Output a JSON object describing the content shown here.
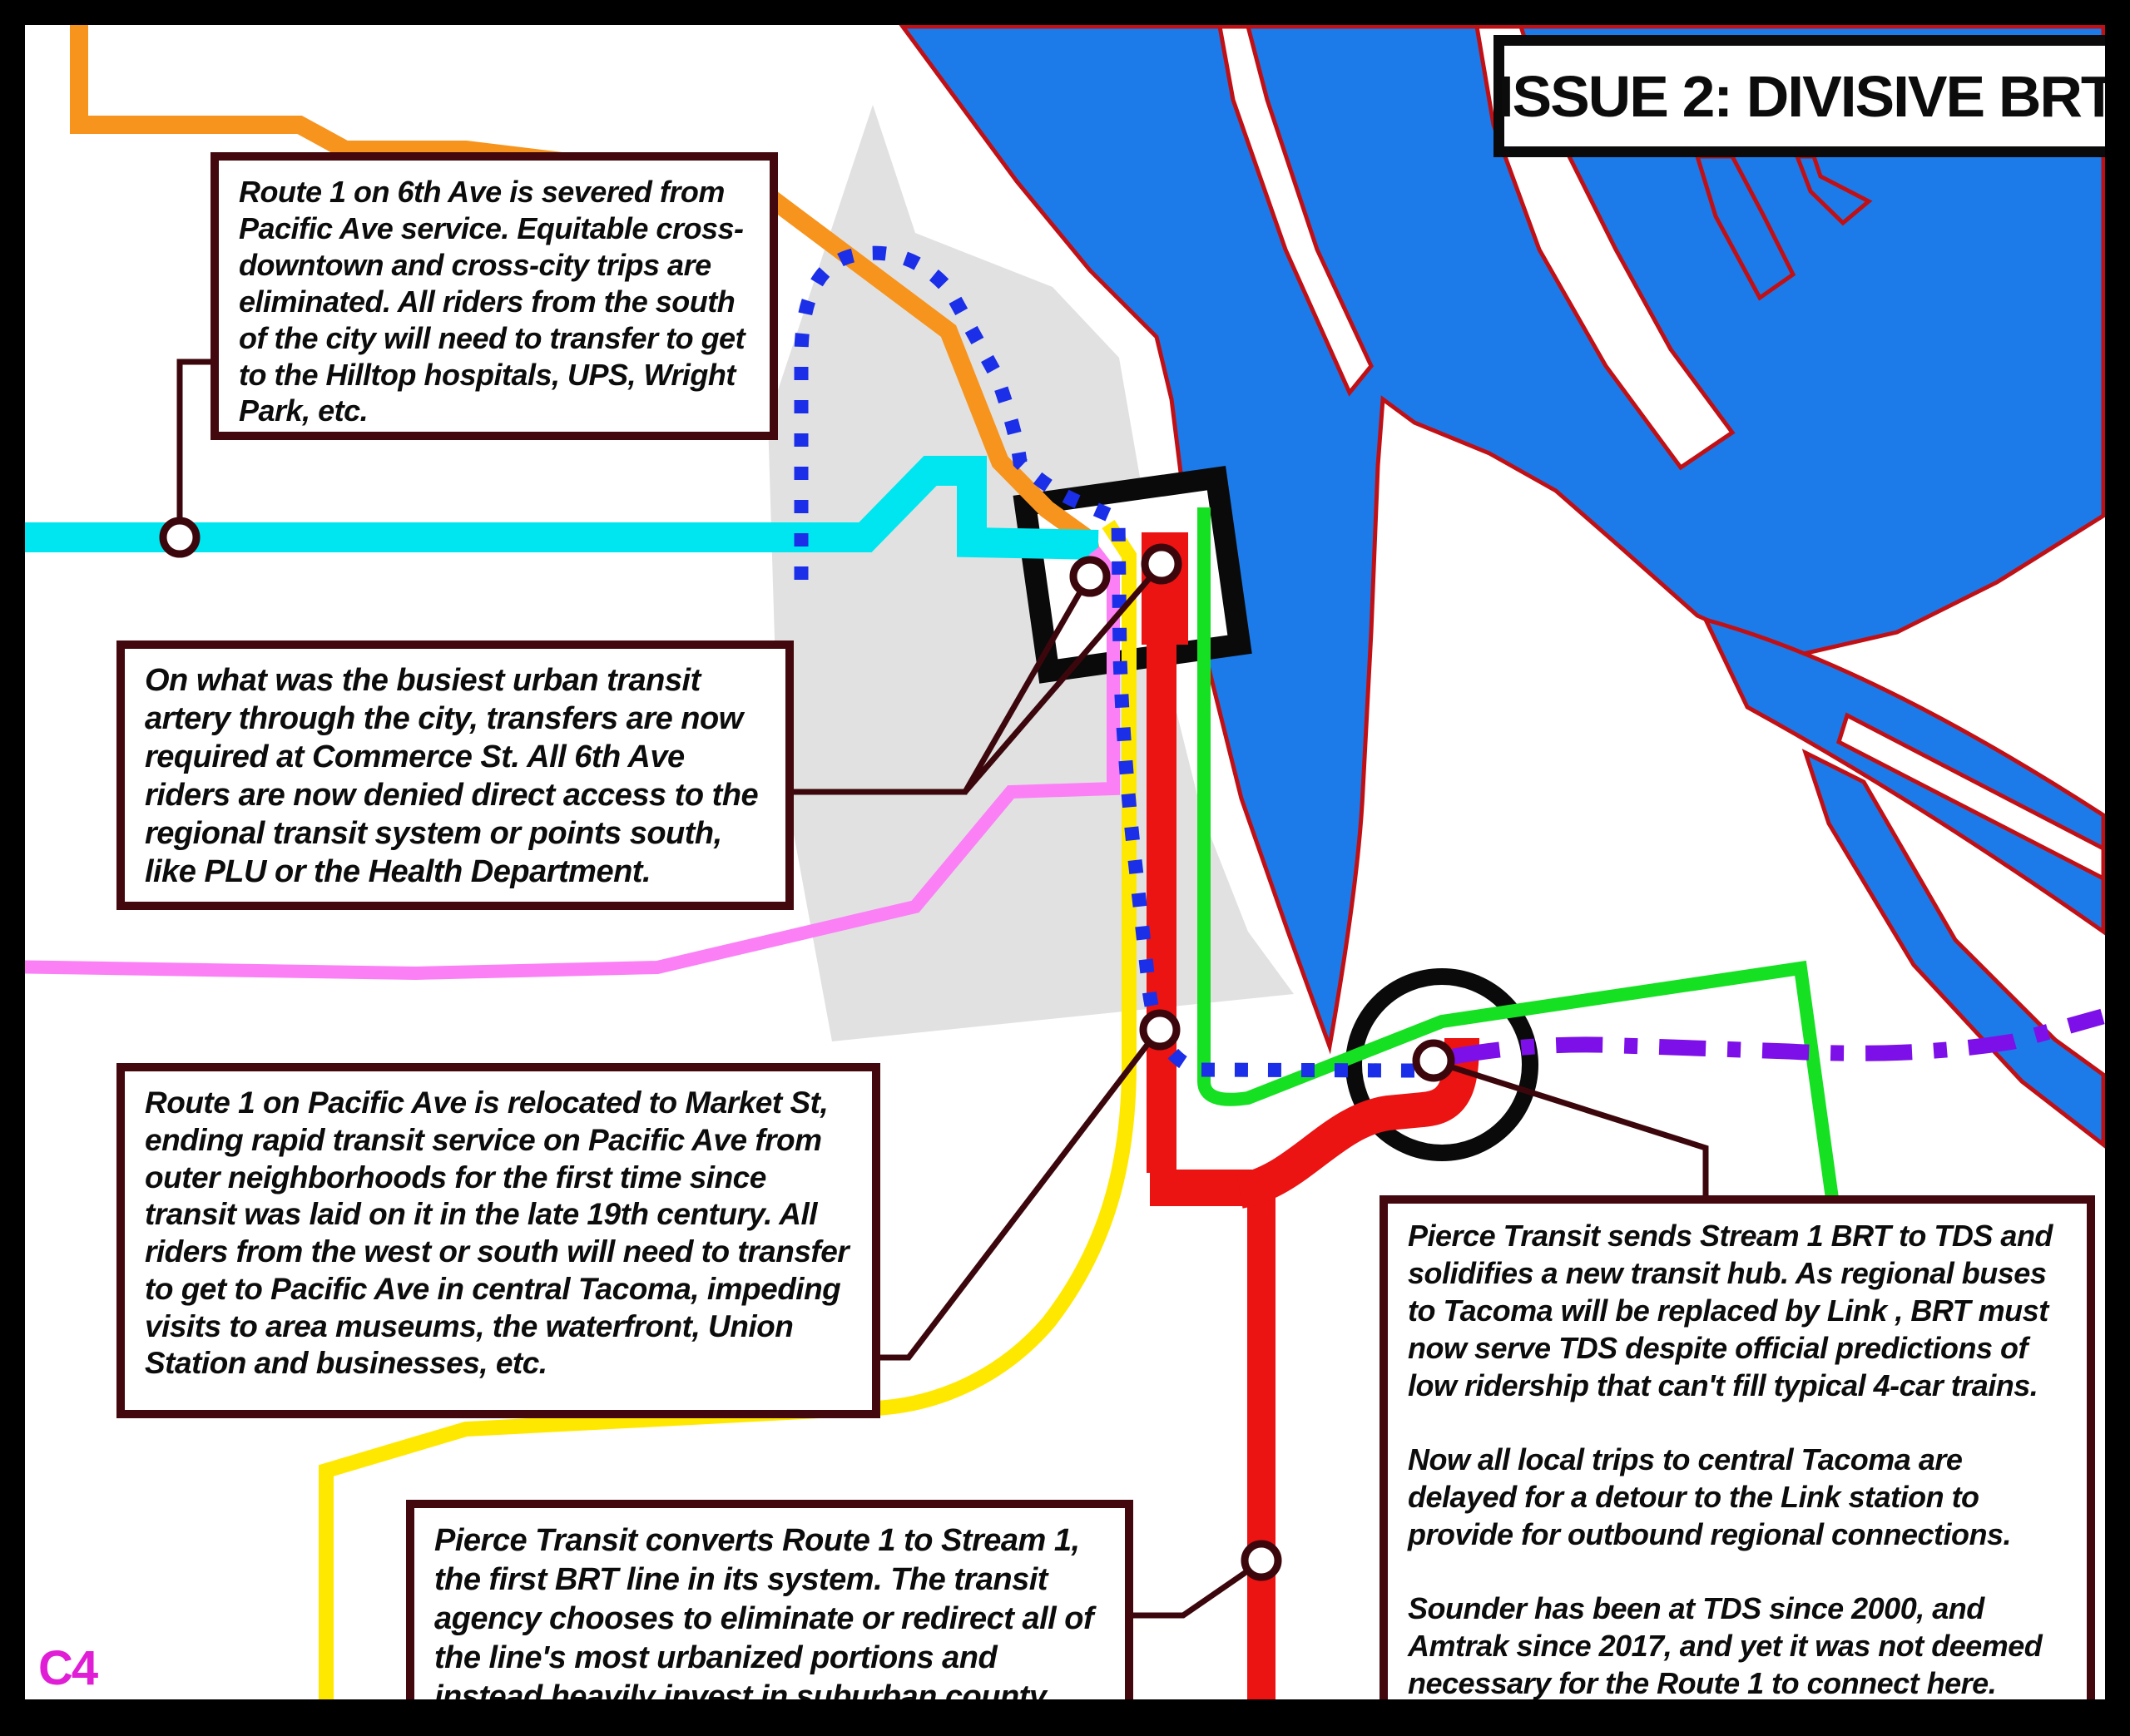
{
  "title": "ISSUE 2: DIVISIVE BRT",
  "page_label": "C4",
  "callouts": {
    "c1": "Route 1 on 6th Ave is severed from Pacific Ave service. Equitable cross-downtown and cross-city trips are eliminated. All riders from the south of the city will need to transfer to get to the Hilltop hospitals, UPS, Wright Park, etc.",
    "c2": "On what was the busiest urban transit artery through the city, transfers are now required at Commerce St. All 6th Ave riders are now denied direct access to the regional transit system or points south, like PLU or the Health Department.",
    "c3": "Route 1 on Pacific Ave is relocated to Market St, ending  rapid transit service on Pacific Ave from outer neighborhoods for the first time since transit was laid on it in the late 19th century. All riders from the west or south will need to transfer to get to Pacific Ave in central Tacoma, impeding visits to area museums, the waterfront, Union Station and businesses, etc.",
    "c4": "Pierce Transit converts Route 1 to Stream 1, the first BRT line in its system. The transit agency chooses to eliminate or redirect all of the line's most urbanized portions and instead heavily invest in suburban county operations.",
    "c5_p1": "Pierce Transit sends Stream 1 BRT to TDS and solidifies a new transit hub. As regional buses to Tacoma will be replaced by Link , BRT must now serve TDS despite official predictions of low ridership that can't fill typical 4-car trains.",
    "c5_p2": "Now all local trips to central Tacoma are delayed for a detour to the Link station to provide for outbound regional connections.",
    "c5_p3": "Sounder has been at TDS since 2000, and Amtrak since 2017, and yet it was not deemed necessary for the Route 1 to connect here."
  },
  "map": {
    "colors": {
      "water": "#1c7be8",
      "water_outline": "#c01015",
      "downtown_gray": "#e1e1e1",
      "route_orange": "#f7941d",
      "route_cyan": "#00e6f0",
      "route_pink": "#fb80f6",
      "route_yellow": "#ffe800",
      "route_red": "#ec1313",
      "route_green": "#16e022",
      "route_blue_dotted": "#1b2fe8",
      "route_purple": "#7d10e8",
      "leader": "#3c070c",
      "highlight_black": "#0a0a0a",
      "page_label": "#e01ed6"
    },
    "routes": [
      {
        "name": "orange-route",
        "color_key": "route_orange",
        "style": "solid"
      },
      {
        "name": "cyan-route",
        "color_key": "route_cyan",
        "style": "solid"
      },
      {
        "name": "pink-route",
        "color_key": "route_pink",
        "style": "solid"
      },
      {
        "name": "yellow-route",
        "color_key": "route_yellow",
        "style": "solid"
      },
      {
        "name": "red-stream1-brt",
        "color_key": "route_red",
        "style": "solid-thick"
      },
      {
        "name": "green-route",
        "color_key": "route_green",
        "style": "solid"
      },
      {
        "name": "blue-dotted-route-1",
        "color_key": "route_blue_dotted",
        "style": "dotted"
      },
      {
        "name": "purple-link-line",
        "color_key": "route_purple",
        "style": "dash-dot"
      }
    ],
    "markers": {
      "stations": 6,
      "highlights": [
        "commerce-st-square",
        "tds-circle"
      ]
    }
  }
}
